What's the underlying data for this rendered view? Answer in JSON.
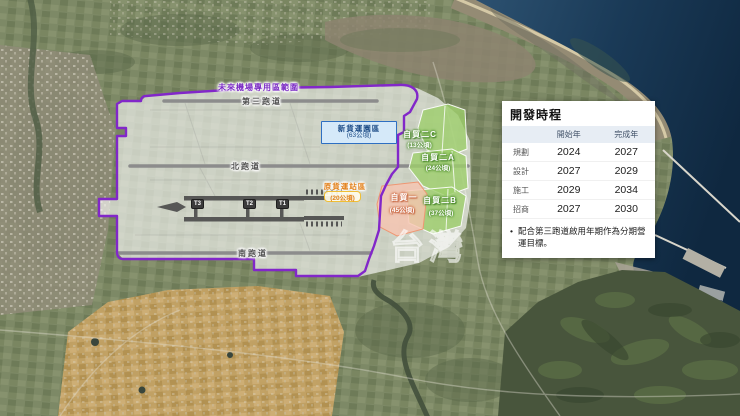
{
  "map": {
    "watermark": "台灣",
    "region_label": "未來機場專用區範圍",
    "runways": [
      {
        "label": "第三跑道"
      },
      {
        "label": "北跑道"
      },
      {
        "label": "南跑道"
      }
    ],
    "terminals": [
      {
        "label": "T3"
      },
      {
        "label": "T2"
      },
      {
        "label": "T1"
      }
    ],
    "zones": {
      "cargo_new": {
        "name": "新貨運園區",
        "area": "(63公頃)"
      },
      "cargo_old": {
        "name": "原貨運站區",
        "area": "(20公頃)"
      },
      "ftz1": {
        "name": "自貿一",
        "area": "(45公頃)"
      },
      "ftz2a": {
        "name": "自貿二A",
        "area": "(24公頃)"
      },
      "ftz2b": {
        "name": "自貿二B",
        "area": "(37公頃)"
      },
      "ftz2c": {
        "name": "自貿二C",
        "area": "(13公頃)"
      }
    },
    "colors": {
      "boundary_purple": "#8227c9",
      "cargo_new_blue": "#2e6fc2",
      "cargo_old_yellow": "#f0bf35",
      "ftz_green": "#9ece6c",
      "ftz_pink": "#f7c4b0",
      "sea_blue": "#1a3a57"
    }
  },
  "panel": {
    "title": "開發時程",
    "table": {
      "headers": [
        "開始年",
        "完成年"
      ],
      "rows": [
        {
          "label": "規劃",
          "start": "2024",
          "end": "2027"
        },
        {
          "label": "設計",
          "start": "2027",
          "end": "2029"
        },
        {
          "label": "施工",
          "start": "2029",
          "end": "2034"
        },
        {
          "label": "招商",
          "start": "2027",
          "end": "2030"
        }
      ]
    },
    "note_bullet": "•",
    "note": "配合第三跑道啟用年期作為分期營運目標。"
  }
}
